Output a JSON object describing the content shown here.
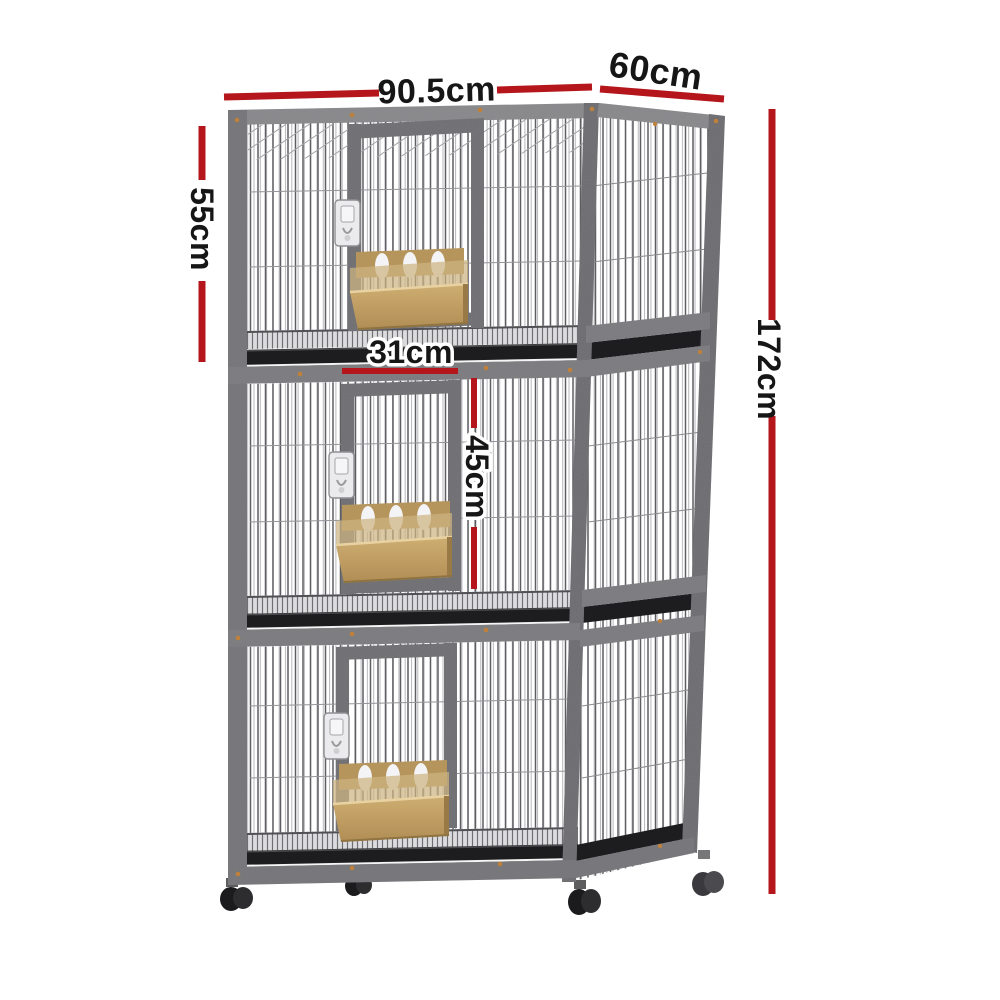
{
  "diagram": {
    "title": "3-tier stacked pet breeding cage with casters - dimension diagram",
    "dimensions": {
      "width": "90.5cm",
      "depth": "60cm",
      "tier_height": "55cm",
      "door_width": "31cm",
      "door_height": "45cm",
      "total_height": "172cm"
    },
    "colors": {
      "dimension_line": "#b5161c",
      "label_text": "#161616",
      "label_outline": "#ffffff",
      "frame_gray": "#757579",
      "frame_light": "#8e8e91",
      "tray_black": "#1d1d1f",
      "feeder_tan": "#c3a164",
      "caster_black": "#1b1b1d",
      "screw_orange": "#c1803a",
      "background": "#ffffff"
    },
    "structure": {
      "tiers": 3,
      "doors": 3,
      "latches": 3,
      "feeder_trays": 3,
      "slide_out_trays": 3,
      "casters": 4
    }
  }
}
